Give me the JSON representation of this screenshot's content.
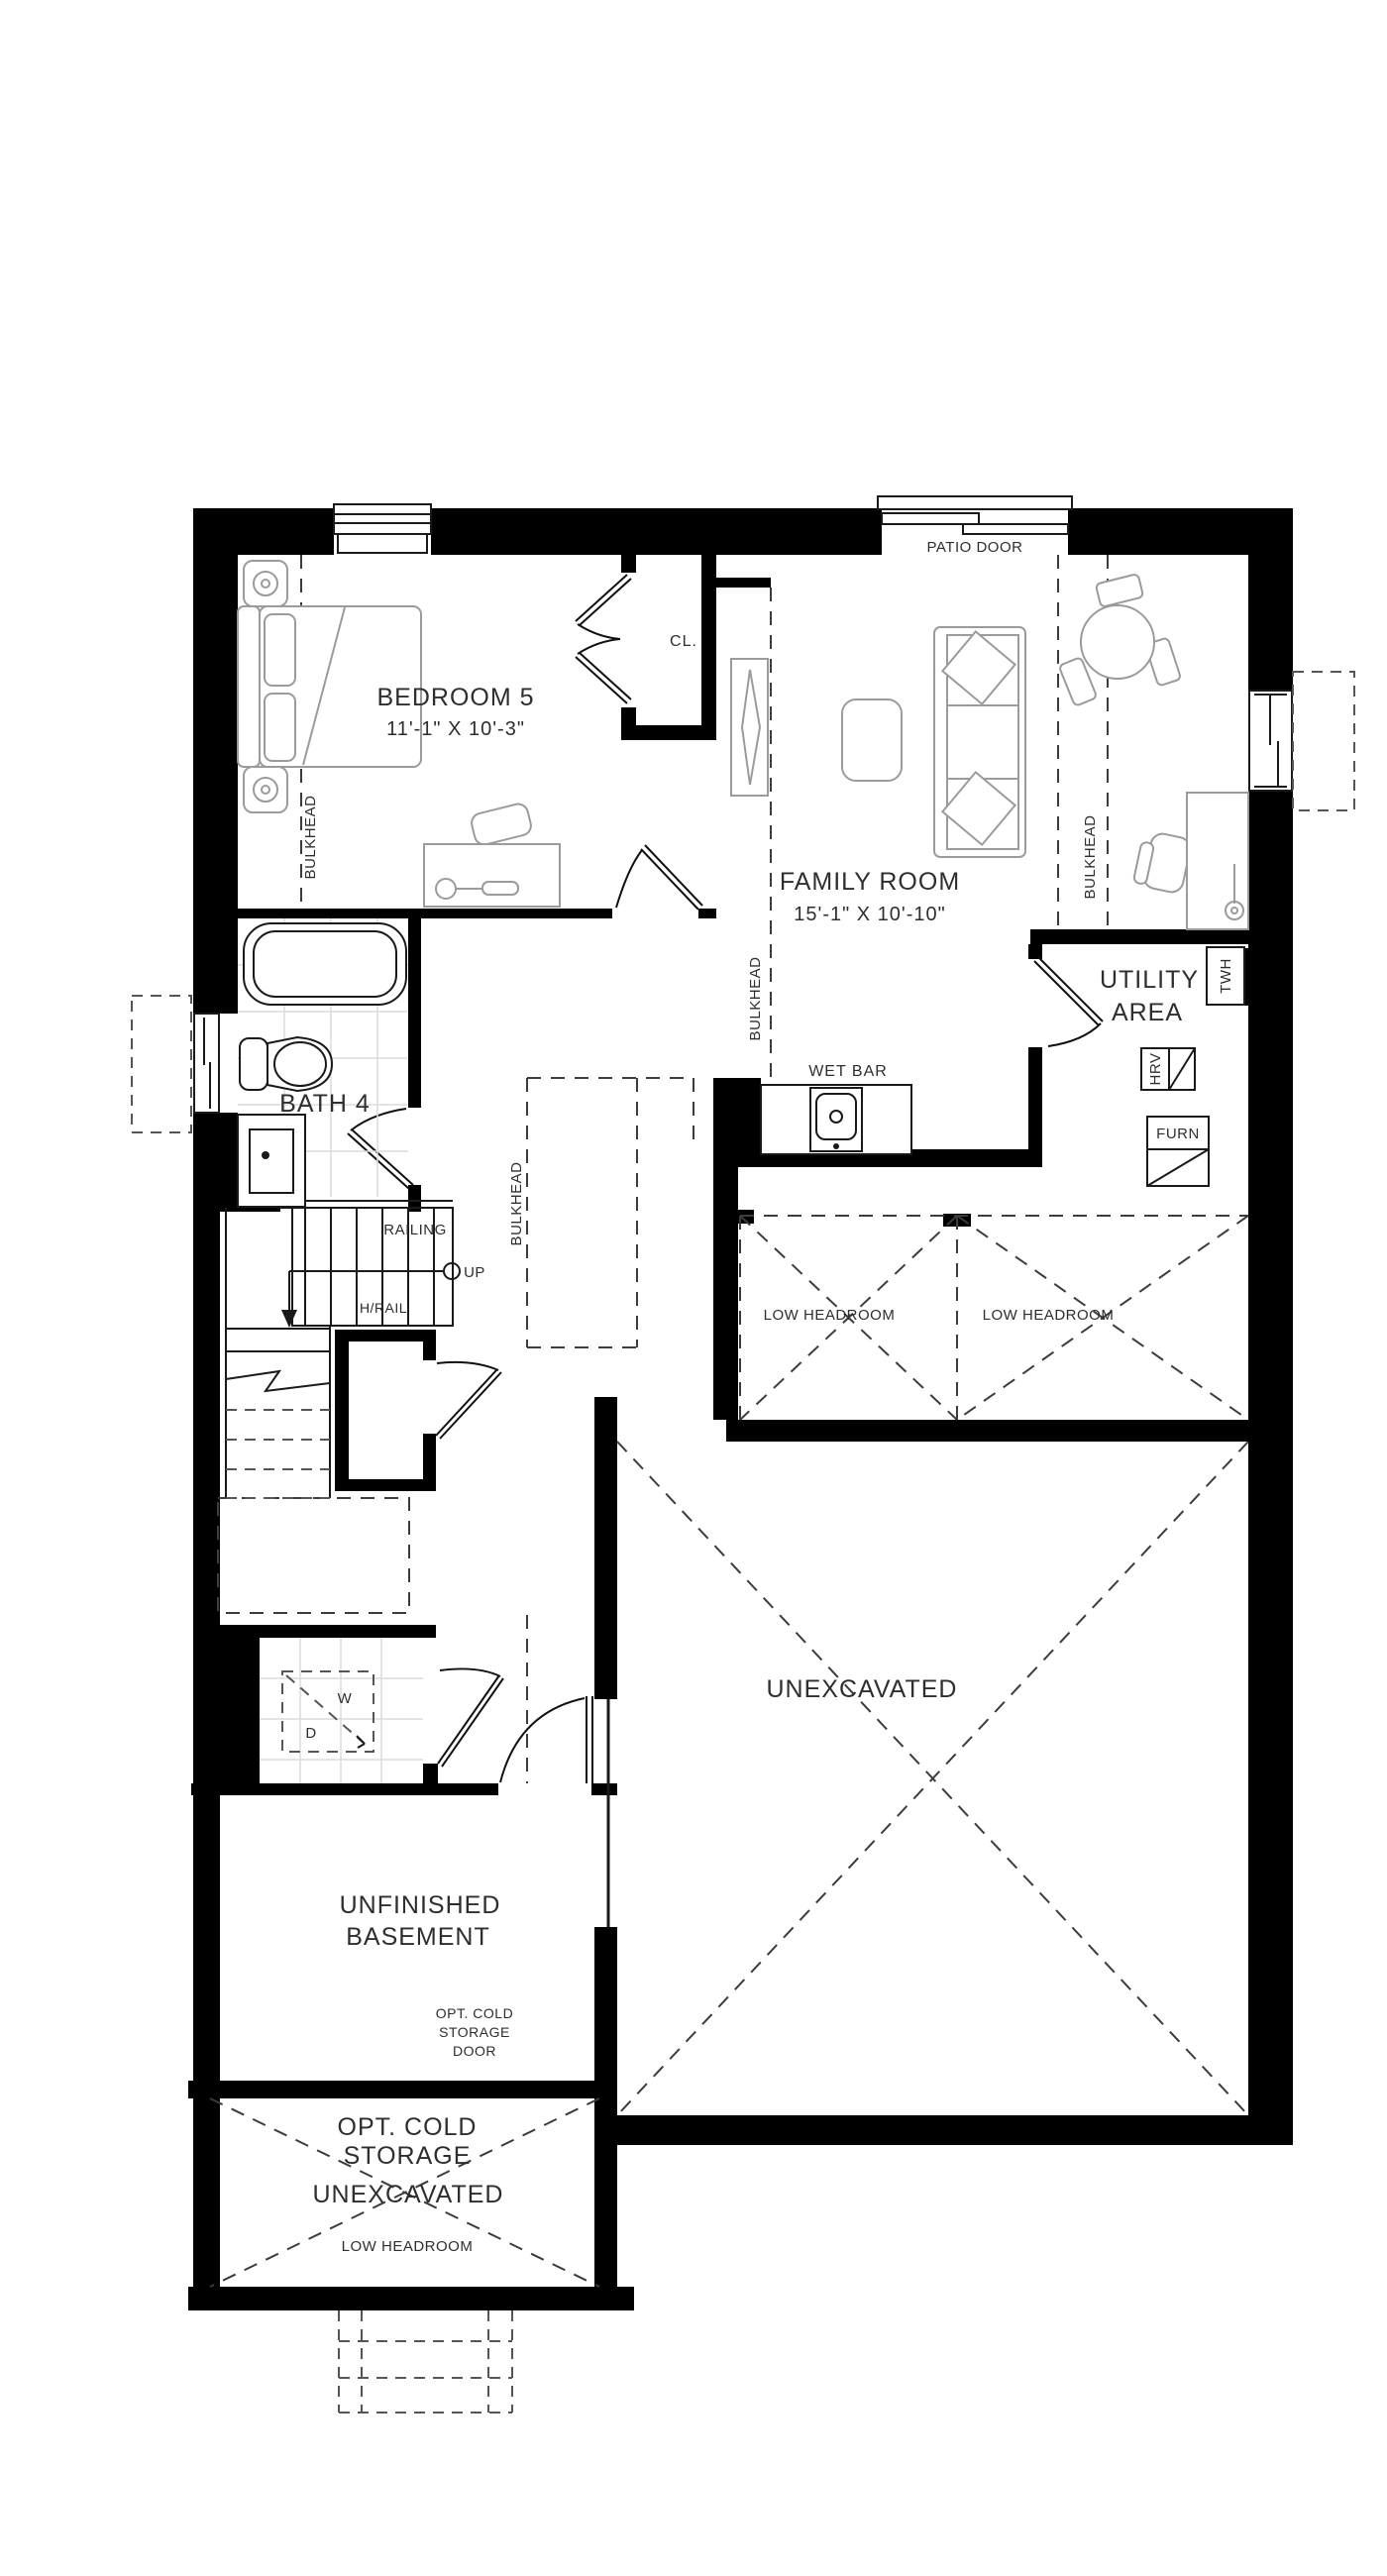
{
  "title": "Basement Floor Plan",
  "colors": {
    "wall": "#000000",
    "ink": "#2e2e2e",
    "furniture": "#9b9b9b",
    "tile": "#dcdcdc",
    "background": "#ffffff"
  },
  "rooms": {
    "bedroom5": {
      "name": "BEDROOM 5",
      "dims": "11'-1\" X 10'-3\""
    },
    "family_room": {
      "name": "FAMILY ROOM",
      "dims": "15'-1\" X 10'-10\""
    },
    "utility_area": {
      "line1": "UTILITY",
      "line2": "AREA"
    },
    "bath4": {
      "name": "BATH 4"
    },
    "unfinished_basement": {
      "line1": "UNFINISHED",
      "line2": "BASEMENT"
    },
    "unexcavated_main": {
      "name": "UNEXCAVATED"
    },
    "cold_storage": {
      "line1": "OPT. COLD",
      "line2": "STORAGE",
      "unexcavated": "UNEXCAVATED",
      "low_headroom": "LOW HEADROOM"
    }
  },
  "labels": {
    "patio_door": "PATIO DOOR",
    "closet": "CL.",
    "wet_bar": "WET BAR",
    "railing": "RAILING",
    "up": "UP",
    "handrail": "H/RAIL",
    "bulkhead": "BULKHEAD",
    "low_headroom": "LOW HEADROOM",
    "washer": "W",
    "dryer": "D",
    "cold_storage_door": {
      "line1": "OPT. COLD",
      "line2": "STORAGE",
      "line3": "DOOR"
    }
  },
  "equipment": {
    "twh": "TWH",
    "hrv": "HRV",
    "furnace": "FURN"
  }
}
